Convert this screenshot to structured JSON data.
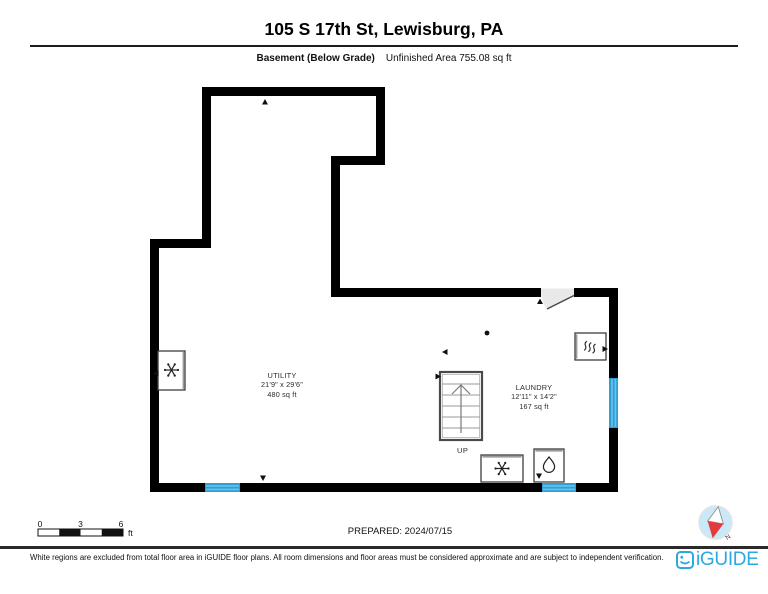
{
  "header": {
    "title": "105 S 17th St, Lewisburg, PA",
    "floor_label": "Basement (Below Grade)",
    "area_label": "Unfinished Area 755.08 sq ft"
  },
  "rooms": {
    "utility": {
      "name": "UTILITY",
      "dimensions": "21'9\" x 29'6\"",
      "area": "480 sq ft"
    },
    "laundry": {
      "name": "LAUNDRY",
      "dimensions": "12'11\" x 14'2\"",
      "area": "167 sq ft"
    }
  },
  "stairs": {
    "direction_label": "UP"
  },
  "scale_bar": {
    "ticks": [
      "0",
      "3",
      "6"
    ],
    "unit": "ft"
  },
  "prepared_label": "PREPARED: 2024/07/15",
  "compass": {
    "north_label": "N"
  },
  "footer": {
    "disclaimer": "White regions are excluded from total floor area in iGUIDE floor plans. All room dimensions and floor areas must be considered approximate and are subject to independent verification.",
    "brand": "iGUIDE"
  },
  "colors": {
    "wall_black": "#000000",
    "window_blue": "#2F9FD8",
    "window_blue_light": "#6CC0EA",
    "brand_blue": "#2BA9E0",
    "compass_fill": "#C9E9F8",
    "compass_red": "#E23B3B",
    "door_swing_gray": "#E9E9E9"
  },
  "icons": {
    "left_wall_appliance": "snowflake-icon",
    "right_wall_appliance": "heat-waves-icon",
    "bottom_left_appliance": "washer-icon",
    "bottom_right_appliance": "water-drop-icon",
    "bottom_right_corner": "compass-icon",
    "footer_brand": "iguide-logo-icon"
  }
}
